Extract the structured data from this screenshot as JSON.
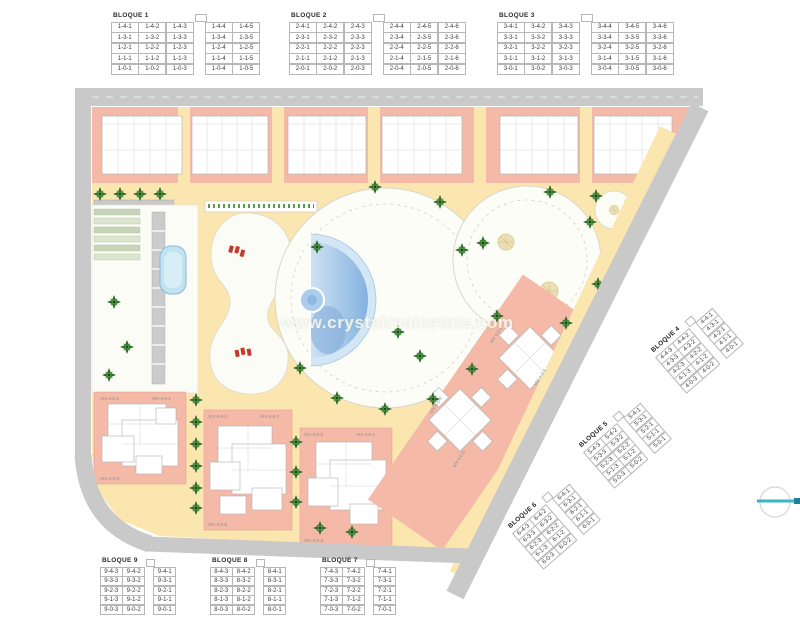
{
  "watermark": {
    "text": "www.crystalrealestate.com"
  },
  "plan": {
    "viv_labels": {
      "a": "VIV 4-0-1",
      "b": "VIV 4-0-2",
      "c": "VIV 4-0-3",
      "d": "VIV 4-0-5"
    },
    "colors": {
      "salmon": "#f4b9a7",
      "path_yellow": "#fbe6af",
      "road_gray": "#c9c9c9",
      "pool_blue": "#9cc4e8",
      "palm_green": "#2e6b2e",
      "lounger_red": "#c43a2e",
      "compass_teal": "#3db5c9"
    }
  },
  "blocks": {
    "top": [
      {
        "name": "BLOQUE 1",
        "gap_after": 3,
        "rows": [
          [
            "1-4-1",
            "1-4-2",
            "1-4-3",
            "1-4-4",
            "1-4-5"
          ],
          [
            "1-3-1",
            "1-3-2",
            "1-3-3",
            "1-3-4",
            "1-3-5"
          ],
          [
            "1-2-1",
            "1-2-2",
            "1-2-3",
            "1-2-4",
            "1-2-5"
          ],
          [
            "1-1-1",
            "1-1-2",
            "1-1-3",
            "1-1-4",
            "1-1-5"
          ],
          [
            "1-0-1",
            "1-0-2",
            "1-0-3",
            "1-0-4",
            "1-0-5"
          ]
        ]
      },
      {
        "name": "BLOQUE 2",
        "gap_after": 3,
        "rows": [
          [
            "2-4-1",
            "2-4-2",
            "2-4-3",
            "2-4-4",
            "2-4-5",
            "2-4-6"
          ],
          [
            "2-3-1",
            "2-3-2",
            "2-3-3",
            "2-3-4",
            "2-3-5",
            "2-3-6"
          ],
          [
            "2-2-1",
            "2-2-2",
            "2-2-3",
            "2-2-4",
            "2-2-5",
            "2-2-6"
          ],
          [
            "2-1-1",
            "2-1-2",
            "2-1-3",
            "2-1-4",
            "2-1-5",
            "2-1-6"
          ],
          [
            "2-0-1",
            "2-0-2",
            "2-0-3",
            "2-0-4",
            "2-0-5",
            "2-0-6"
          ]
        ]
      },
      {
        "name": "BLOQUE 3",
        "gap_after": 3,
        "rows": [
          [
            "3-4-1",
            "3-4-2",
            "3-4-3",
            "3-4-4",
            "3-4-5",
            "3-4-6"
          ],
          [
            "3-3-1",
            "3-3-2",
            "3-3-3",
            "3-3-4",
            "3-3-5",
            "3-3-6"
          ],
          [
            "3-2-1",
            "3-2-2",
            "3-2-3",
            "3-2-4",
            "3-2-5",
            "3-2-6"
          ],
          [
            "3-1-1",
            "3-1-2",
            "3-1-3",
            "3-1-4",
            "3-1-5",
            "3-1-6"
          ],
          [
            "3-0-1",
            "3-0-2",
            "3-0-3",
            "3-0-4",
            "3-0-5",
            "3-0-6"
          ]
        ]
      }
    ],
    "right": [
      {
        "name": "BLOQUE 4",
        "gap_after": 2,
        "rows": [
          [
            "4-4-3",
            "4-4-2",
            "4-4-1"
          ],
          [
            "4-3-3",
            "4-3-2",
            "4-3-1"
          ],
          [
            "4-2-3",
            "4-2-2",
            "4-2-1"
          ],
          [
            "4-1-3",
            "4-1-2",
            "4-1-1"
          ],
          [
            "4-0-3",
            "4-0-2",
            "4-0-1"
          ]
        ]
      },
      {
        "name": "BLOQUE 5",
        "gap_after": 2,
        "rows": [
          [
            "5-4-3",
            "5-4-2",
            "5-4-1"
          ],
          [
            "5-3-3",
            "5-3-2",
            "5-3-1"
          ],
          [
            "5-2-3",
            "5-2-2",
            "5-2-1"
          ],
          [
            "5-1-3",
            "5-1-2",
            "5-1-1"
          ],
          [
            "5-0-3",
            "5-0-2",
            "5-0-1"
          ]
        ]
      },
      {
        "name": "BLOQUE 6",
        "gap_after": 2,
        "rows": [
          [
            "6-4-3",
            "6-4-2",
            "6-4-1"
          ],
          [
            "6-3-3",
            "6-3-2",
            "6-3-1"
          ],
          [
            "6-2-3",
            "6-2-2",
            "6-2-1"
          ],
          [
            "6-1-3",
            "6-1-2",
            "6-1-1"
          ],
          [
            "6-0-3",
            "6-0-2",
            "6-0-1"
          ]
        ]
      }
    ],
    "bottom": [
      {
        "name": "BLOQUE 9",
        "gap_after": 2,
        "rows": [
          [
            "9-4-3",
            "9-4-2",
            "9-4-1"
          ],
          [
            "9-3-3",
            "9-3-2",
            "9-3-1"
          ],
          [
            "9-2-3",
            "9-2-2",
            "9-2-1"
          ],
          [
            "9-1-3",
            "9-1-2",
            "9-1-1"
          ],
          [
            "9-0-3",
            "9-0-2",
            "9-0-1"
          ]
        ]
      },
      {
        "name": "BLOQUE 8",
        "gap_after": 2,
        "rows": [
          [
            "8-4-3",
            "8-4-2",
            "8-4-1"
          ],
          [
            "8-3-3",
            "8-3-2",
            "8-3-1"
          ],
          [
            "8-2-3",
            "8-2-2",
            "8-2-1"
          ],
          [
            "8-1-3",
            "8-1-2",
            "8-1-1"
          ],
          [
            "8-0-3",
            "8-0-2",
            "8-0-1"
          ]
        ]
      },
      {
        "name": "BLOQUE 7",
        "gap_after": 2,
        "rows": [
          [
            "7-4-3",
            "7-4-2",
            "7-4-1"
          ],
          [
            "7-3-3",
            "7-3-2",
            "7-3-1"
          ],
          [
            "7-2-3",
            "7-2-2",
            "7-2-1"
          ],
          [
            "7-1-3",
            "7-1-2",
            "7-1-1"
          ],
          [
            "7-0-3",
            "7-0-2",
            "7-0-1"
          ]
        ]
      }
    ]
  }
}
